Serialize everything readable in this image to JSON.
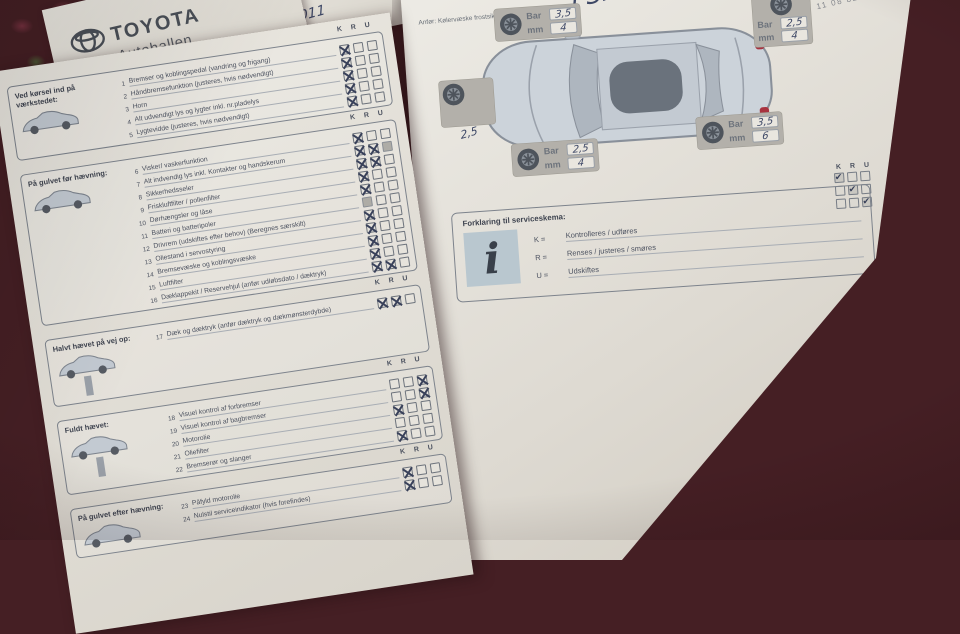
{
  "letterhead": {
    "brand": "TOYOTA",
    "dealer": "Autohallen",
    "address": "Slagelsevej 242, 4400 K",
    "handwritten_date": "3-5-2011"
  },
  "left_page": {
    "kru_header": [
      "K",
      "R",
      "U"
    ],
    "sections": [
      {
        "title": "Ved kørsel ind på værkstedet:",
        "icon": "car-side",
        "items": [
          {
            "num": 1,
            "label": "Bremser og koblingspedal (vandring og frigang)",
            "marks": [
              "K"
            ],
            "grey": []
          },
          {
            "num": 2,
            "label": "Håndbremsefunktion (justeres, hvis nødvendigt)",
            "marks": [
              "K"
            ],
            "grey": []
          },
          {
            "num": 3,
            "label": "Horn",
            "marks": [
              "K"
            ],
            "grey": []
          },
          {
            "num": 4,
            "label": "Alt udvendigt lys og lygter inkl. nr.pladelys",
            "marks": [
              "K"
            ],
            "grey": []
          },
          {
            "num": 5,
            "label": "Lygtevidde (justeres, hvis nødvendigt)",
            "marks": [
              "K"
            ],
            "grey": []
          }
        ]
      },
      {
        "title": "På gulvet før hævning:",
        "icon": "car-side",
        "items": [
          {
            "num": 6,
            "label": "Visker/ vaskerfunktion",
            "marks": [
              "K"
            ],
            "grey": []
          },
          {
            "num": 7,
            "label": "Alt indvendig lys inkl. Kontakter og handskerum",
            "marks": [
              "K",
              "R"
            ],
            "grey": [
              "U"
            ]
          },
          {
            "num": 8,
            "label": "Sikkerhedsseler",
            "marks": [
              "K",
              "R"
            ],
            "grey": []
          },
          {
            "num": 9,
            "label": "Friskluftfilter / pollenfilter",
            "marks": [
              "K"
            ],
            "grey": []
          },
          {
            "num": 10,
            "label": "Dørhængsler og låse",
            "marks": [
              "K"
            ],
            "grey": []
          },
          {
            "num": 11,
            "label": "Batteri og batteripoler",
            "marks": [],
            "grey": [
              "K"
            ]
          },
          {
            "num": 12,
            "label": "Drivrem (udskiftes efter behov) (Beregnes særskilt)",
            "marks": [
              "K"
            ],
            "grey": []
          },
          {
            "num": 13,
            "label": "Oliestand i servostyring",
            "marks": [
              "K"
            ],
            "grey": []
          },
          {
            "num": 14,
            "label": "Bremsevæske og koblingsvæske",
            "marks": [
              "K"
            ],
            "grey": []
          },
          {
            "num": 15,
            "label": "Luftfilter",
            "marks": [
              "K"
            ],
            "grey": []
          },
          {
            "num": 16,
            "label": "Dæklappekit / Reservehjul (anfør udløbsdato / dæktryk)",
            "marks": [
              "K",
              "R"
            ],
            "grey": []
          }
        ]
      },
      {
        "title": "Halvt hævet på vej op:",
        "icon": "car-lift",
        "items": [
          {
            "num": 17,
            "label": "Dæk og dæktryk (anfør dæktryk og dækmønsterdybde)",
            "marks": [
              "K",
              "R"
            ],
            "grey": []
          }
        ]
      },
      {
        "title": "Fuldt hævet:",
        "icon": "car-lift",
        "items": [
          {
            "num": 18,
            "label": "Visuel kontrol af forbremser",
            "marks": [
              "U"
            ],
            "grey": []
          },
          {
            "num": 19,
            "label": "Visuel kontrol af bagbremser",
            "marks": [
              "U"
            ],
            "grey": []
          },
          {
            "num": 20,
            "label": "Motorolie",
            "marks": [
              "K"
            ],
            "grey": []
          },
          {
            "num": 21,
            "label": "Oliefilter",
            "marks": [],
            "grey": []
          },
          {
            "num": 22,
            "label": "Bremserør og slanger",
            "marks": [
              "K"
            ],
            "grey": []
          }
        ]
      },
      {
        "title": "På gulvet efter hævning:",
        "icon": "car-side",
        "items": [
          {
            "num": 23,
            "label": "Påfyld motorolie",
            "marks": [
              "K"
            ],
            "grey": []
          },
          {
            "num": 24,
            "label": "Nulstil serviceindikator (hvis forefindes)",
            "marks": [
              "K"
            ],
            "grey": []
          }
        ]
      }
    ]
  },
  "right_page": {
    "top_note": "Anfør: Kølervæske frostsikring, ...",
    "stamp": "11 08 82",
    "handwriting_psi": "PSI",
    "bar_label": "Bar",
    "mm_label": "mm",
    "tires": [
      {
        "pos": "top-left",
        "bar": "3,5",
        "mm": "4"
      },
      {
        "pos": "top-right",
        "bar": "2,5",
        "mm": "4"
      },
      {
        "pos": "bottom-right",
        "bar": "3,5",
        "mm": "6"
      },
      {
        "pos": "bottom-left",
        "bar": "2,5",
        "mm": "4"
      }
    ],
    "spare_value": "2,5",
    "kru_header": [
      "K",
      "R",
      "U"
    ],
    "kru_checks": [
      [
        true,
        false,
        false
      ],
      [
        false,
        true,
        false
      ],
      [
        false,
        false,
        true
      ]
    ],
    "legend": {
      "title": "Forklaring til serviceskema:",
      "entries": [
        {
          "key": "K =",
          "value": "Kontrolleres / udføres"
        },
        {
          "key": "R =",
          "value": "Renses / justeres / smøres"
        },
        {
          "key": "U =",
          "value": "Udskiftes"
        }
      ]
    }
  }
}
